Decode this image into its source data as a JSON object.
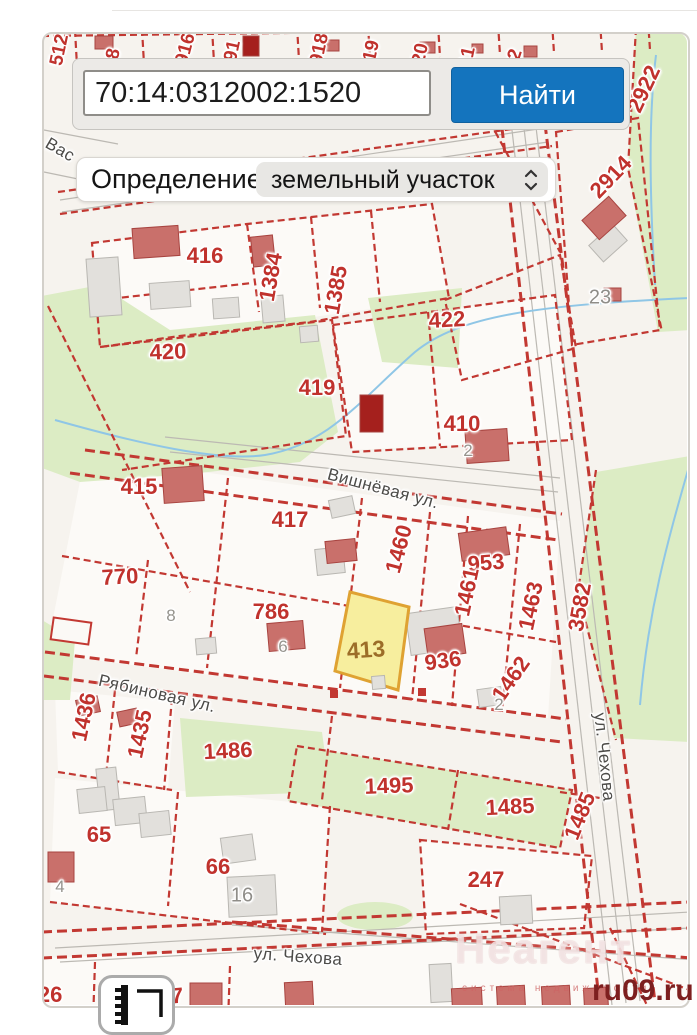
{
  "search": {
    "value": "70:14:0312002:1520",
    "button_label": "Найти"
  },
  "filter": {
    "label": "Определение:",
    "selected_option": "земельный участок"
  },
  "map": {
    "highlighted_parcel": {
      "id": "413",
      "fill": "#f7ee9e",
      "border": "#dfa232"
    },
    "colors": {
      "accent_blue": "#1474be",
      "parcel_red": "#c23832",
      "green_area": "#dcecc4",
      "water_blue": "#8fc6e6"
    },
    "labels": [
      {
        "t": "512",
        "x": 60,
        "y": 50,
        "r": -78,
        "c": "redsm"
      },
      {
        "t": "8",
        "x": 114,
        "y": 54,
        "r": -78,
        "c": "redsm"
      },
      {
        "t": "916",
        "x": 186,
        "y": 49,
        "r": -75,
        "c": "redsm"
      },
      {
        "t": "91",
        "x": 233,
        "y": 51,
        "r": -78,
        "c": "redsm"
      },
      {
        "t": "918",
        "x": 320,
        "y": 49,
        "r": -78,
        "c": "redsm"
      },
      {
        "t": "19",
        "x": 372,
        "y": 51,
        "r": -78,
        "c": "redsm"
      },
      {
        "t": "20",
        "x": 421,
        "y": 54,
        "r": -78,
        "c": "redsm"
      },
      {
        "t": "11",
        "x": 468,
        "y": 57,
        "r": -78,
        "c": "redsm"
      },
      {
        "t": "22",
        "x": 514,
        "y": 60,
        "r": -72,
        "c": "redsm"
      },
      {
        "t": "2922",
        "x": 644,
        "y": 89,
        "r": -65,
        "c": "red"
      },
      {
        "t": "2914",
        "x": 611,
        "y": 177,
        "r": -46,
        "c": "red"
      },
      {
        "t": "23",
        "x": 600,
        "y": 298,
        "r": 0,
        "c": "graylg"
      },
      {
        "t": "416",
        "x": 205,
        "y": 256,
        "r": 0,
        "c": "red"
      },
      {
        "t": "1384",
        "x": 271,
        "y": 277,
        "r": -80,
        "c": "red"
      },
      {
        "t": "1385",
        "x": 336,
        "y": 290,
        "r": -80,
        "c": "red"
      },
      {
        "t": "422",
        "x": 447,
        "y": 320,
        "r": -3,
        "c": "red"
      },
      {
        "t": "420",
        "x": 168,
        "y": 352,
        "r": -2,
        "c": "red"
      },
      {
        "t": "419",
        "x": 317,
        "y": 388,
        "r": 0,
        "c": "red"
      },
      {
        "t": "410",
        "x": 462,
        "y": 424,
        "r": 0,
        "c": "red"
      },
      {
        "t": "2",
        "x": 468,
        "y": 451,
        "r": 0,
        "c": "gray"
      },
      {
        "t": "415",
        "x": 139,
        "y": 487,
        "r": 0,
        "c": "red"
      },
      {
        "t": "417",
        "x": 290,
        "y": 520,
        "r": 0,
        "c": "red"
      },
      {
        "t": "1460",
        "x": 399,
        "y": 549,
        "r": -75,
        "c": "red"
      },
      {
        "t": "953",
        "x": 486,
        "y": 563,
        "r": -5,
        "c": "red"
      },
      {
        "t": "1461",
        "x": 467,
        "y": 592,
        "r": -78,
        "c": "red"
      },
      {
        "t": "1463",
        "x": 531,
        "y": 606,
        "r": -78,
        "c": "red"
      },
      {
        "t": "3582",
        "x": 580,
        "y": 607,
        "r": -80,
        "c": "red"
      },
      {
        "t": "770",
        "x": 120,
        "y": 577,
        "r": -3,
        "c": "red"
      },
      {
        "t": "8",
        "x": 171,
        "y": 616,
        "r": 0,
        "c": "gray"
      },
      {
        "t": "786",
        "x": 271,
        "y": 612,
        "r": 0,
        "c": "red"
      },
      {
        "t": "6",
        "x": 283,
        "y": 647,
        "r": 0,
        "c": "gray"
      },
      {
        "t": "413",
        "x": 366,
        "y": 650,
        "r": -4,
        "c": "brown"
      },
      {
        "t": "936",
        "x": 443,
        "y": 661,
        "r": -8,
        "c": "red"
      },
      {
        "t": "1462",
        "x": 511,
        "y": 679,
        "r": -55,
        "c": "red"
      },
      {
        "t": "2",
        "x": 499,
        "y": 705,
        "r": 0,
        "c": "gray"
      },
      {
        "t": "1436",
        "x": 84,
        "y": 717,
        "r": -78,
        "c": "red"
      },
      {
        "t": "1435",
        "x": 140,
        "y": 734,
        "r": -78,
        "c": "red"
      },
      {
        "t": "1486",
        "x": 228,
        "y": 751,
        "r": -3,
        "c": "red"
      },
      {
        "t": "65",
        "x": 99,
        "y": 835,
        "r": 0,
        "c": "red"
      },
      {
        "t": "66",
        "x": 218,
        "y": 867,
        "r": 0,
        "c": "red"
      },
      {
        "t": "16",
        "x": 242,
        "y": 896,
        "r": 0,
        "c": "graylg"
      },
      {
        "t": "4",
        "x": 60,
        "y": 887,
        "r": 0,
        "c": "gray"
      },
      {
        "t": "1495",
        "x": 389,
        "y": 786,
        "r": -2,
        "c": "red"
      },
      {
        "t": "1485",
        "x": 510,
        "y": 807,
        "r": -3,
        "c": "red"
      },
      {
        "t": "1485",
        "x": 580,
        "y": 816,
        "r": -68,
        "c": "red"
      },
      {
        "t": "247",
        "x": 486,
        "y": 880,
        "r": 0,
        "c": "red"
      },
      {
        "t": "137",
        "x": 165,
        "y": 997,
        "r": -5,
        "c": "red"
      },
      {
        "t": "126",
        "x": 44,
        "y": 995,
        "r": 0,
        "c": "red"
      },
      {
        "t": "Вас",
        "x": 60,
        "y": 150,
        "r": 30,
        "c": "street"
      },
      {
        "t": "Вишнёвая ул.",
        "x": 383,
        "y": 489,
        "r": 15,
        "c": "street"
      },
      {
        "t": "Рябиновая ул.",
        "x": 157,
        "y": 694,
        "r": 13,
        "c": "street"
      },
      {
        "t": "ул. Чехова",
        "x": 604,
        "y": 757,
        "r": 84,
        "c": "street"
      },
      {
        "t": "ул. Чехова",
        "x": 298,
        "y": 957,
        "r": 4,
        "c": "street"
      }
    ]
  },
  "watermark": {
    "brand": "Неагент",
    "tagline": "система недвижимости",
    "site": "ru09.ru"
  }
}
